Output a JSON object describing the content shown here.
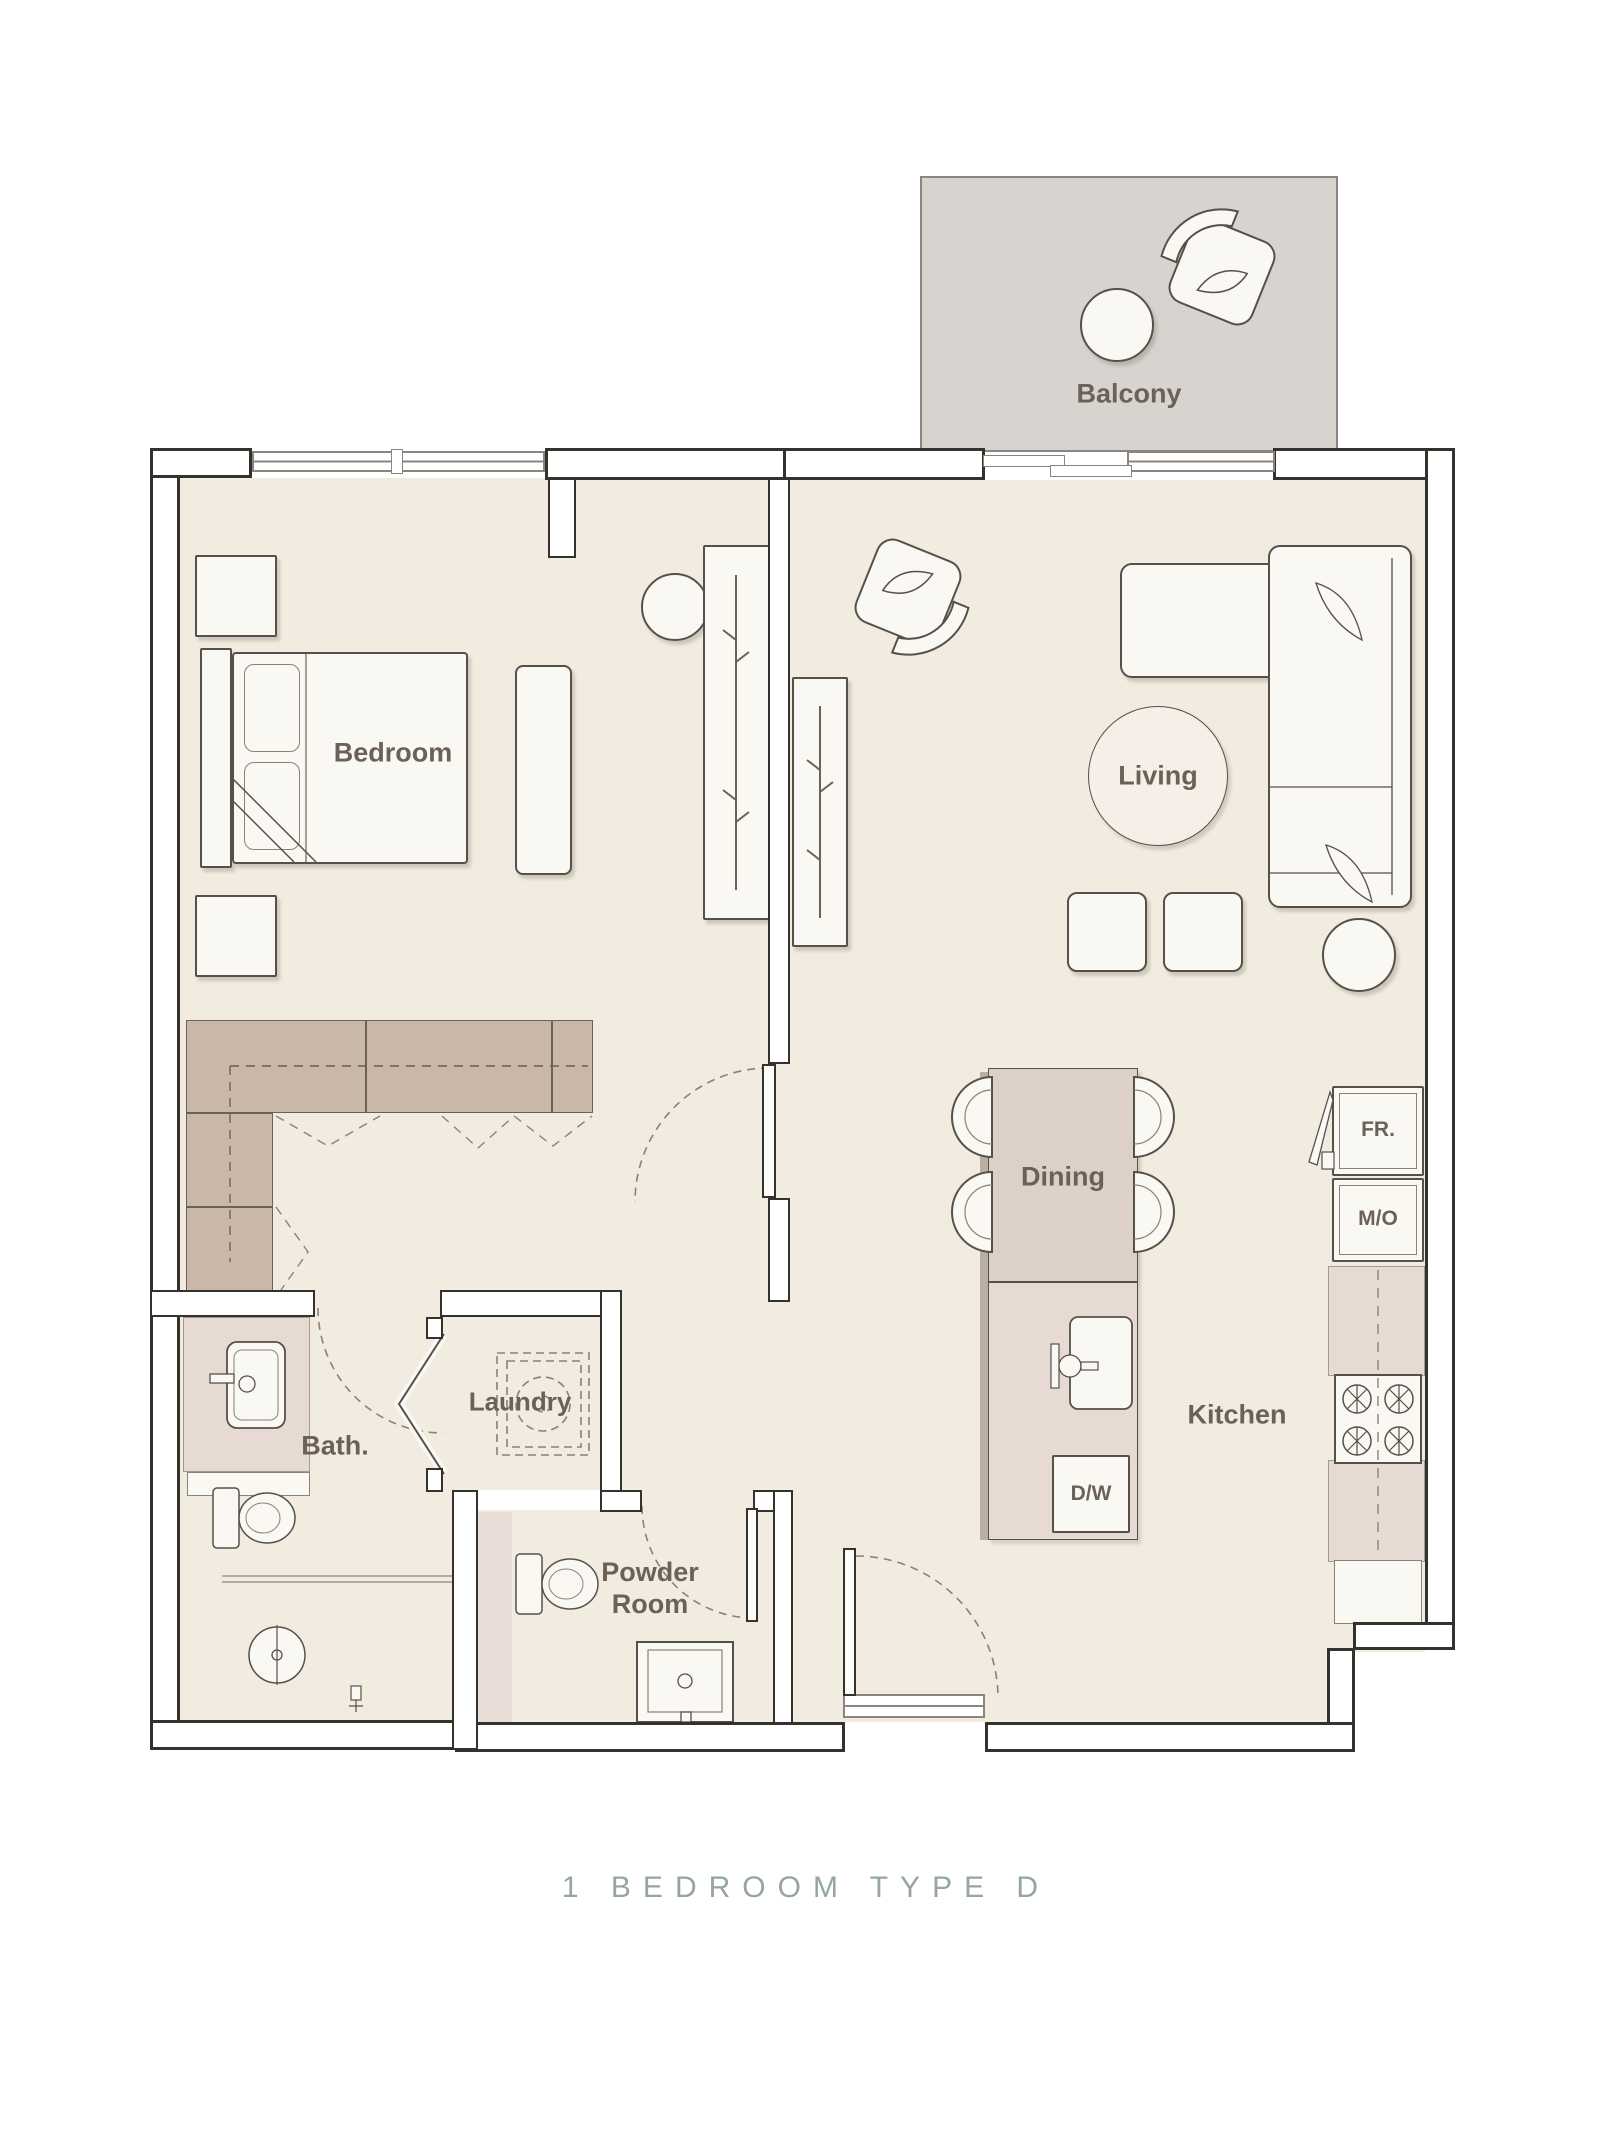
{
  "title": "1 BEDROOM TYPE D",
  "rooms": {
    "balcony": "Balcony",
    "bedroom": "Bedroom",
    "living": "Living",
    "dining": "Dining",
    "kitchen": "Kitchen",
    "bath": "Bath.",
    "laundry": "Laundry",
    "powder": "Powder Room"
  },
  "appliances": {
    "fridge": "FR.",
    "microwave_oven": "M/O",
    "dishwasher": "D/W"
  },
  "colors": {
    "floor": "#f2ece0",
    "balcony_floor": "#d7d3cf",
    "closet": "#c9b7a7",
    "counter": "#e7dad2",
    "wall": "#35312d",
    "label_text": "#6b6156",
    "title_text": "#95a5a4"
  }
}
